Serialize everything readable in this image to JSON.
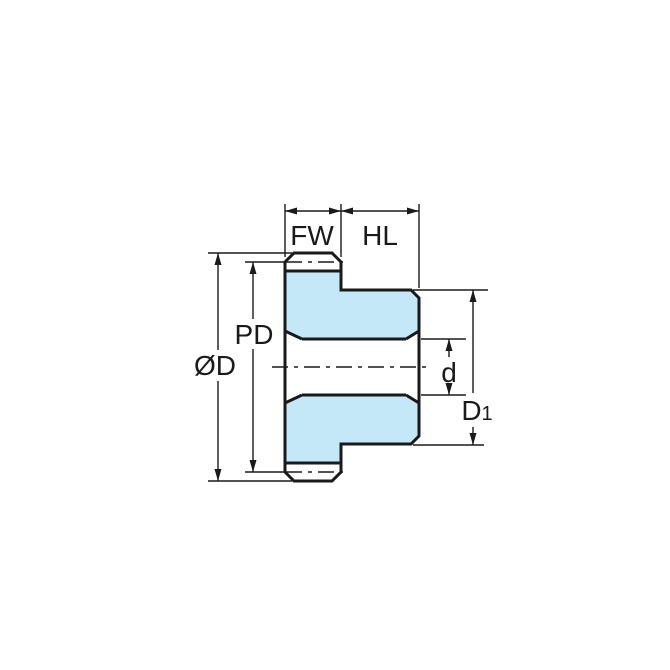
{
  "diagram": {
    "labels": {
      "face_width": "FW",
      "hub_length": "HL",
      "pitch_diameter": "PD",
      "outside_diameter": "ØD",
      "bore_diameter": "d",
      "hub_diameter_base": "D",
      "hub_diameter_subscript": "1"
    },
    "colors": {
      "part_fill": "#c5e8f9",
      "line": "#1a1a1a",
      "background": "#ffffff"
    }
  }
}
